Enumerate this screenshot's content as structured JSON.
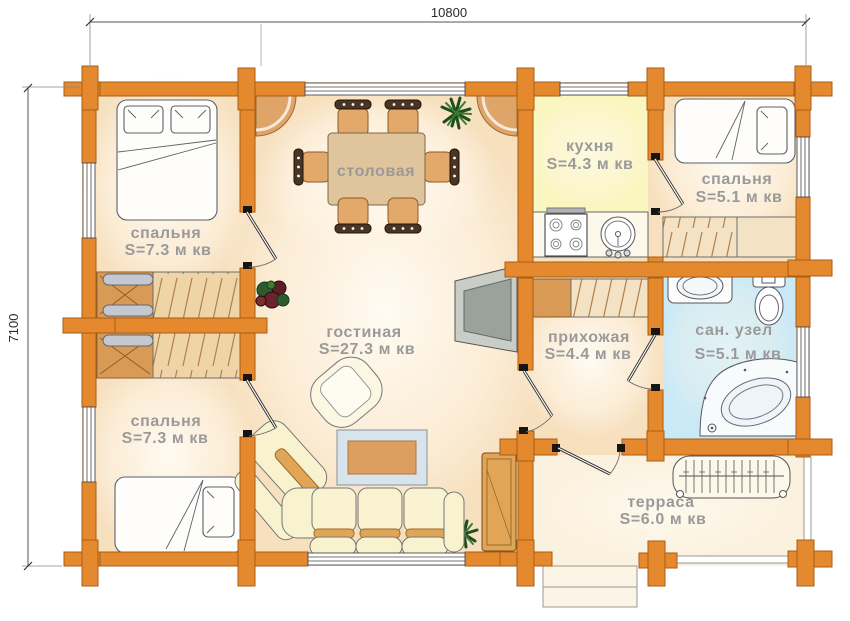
{
  "dimensions": {
    "width": "10800",
    "height": "7100"
  },
  "rooms": [
    {
      "id": "bedroom-top-left",
      "name": "спальня",
      "area": "S=7.3 м кв"
    },
    {
      "id": "dining-room",
      "name": "столовая"
    },
    {
      "id": "kitchen",
      "name": "кухня",
      "area": "S=4.3 м кв"
    },
    {
      "id": "bedroom-top-right",
      "name": "спальня",
      "area": "S=5.1 м кв"
    },
    {
      "id": "living-room",
      "name": "гостиная",
      "area": "S=27.3 м кв"
    },
    {
      "id": "hallway",
      "name": "прихожая",
      "area": "S=4.4 м кв"
    },
    {
      "id": "bathroom",
      "name": "сан. узел",
      "area": "S=5.1 м кв"
    },
    {
      "id": "bedroom-bottom-left",
      "name": "спальня",
      "area": "S=7.3 м кв"
    },
    {
      "id": "terrace",
      "name": "терраса",
      "area": "S=6.0 м кв"
    }
  ],
  "colors": {
    "wall": "#E5892F",
    "wall_outline": "#A85E14",
    "floor_peach": "#F8E2C2",
    "kitchen_floor": "#FAF6C0",
    "bathroom_floor": "#C9E9F6",
    "terrace_floor": "#FAF1DE",
    "furniture_tan": "#DFA468",
    "wardrobe_brown": "#D89A55",
    "sofa_cream": "#F9F2CF",
    "label_text": "#9A9A9A",
    "dimension_text": "#222222"
  }
}
